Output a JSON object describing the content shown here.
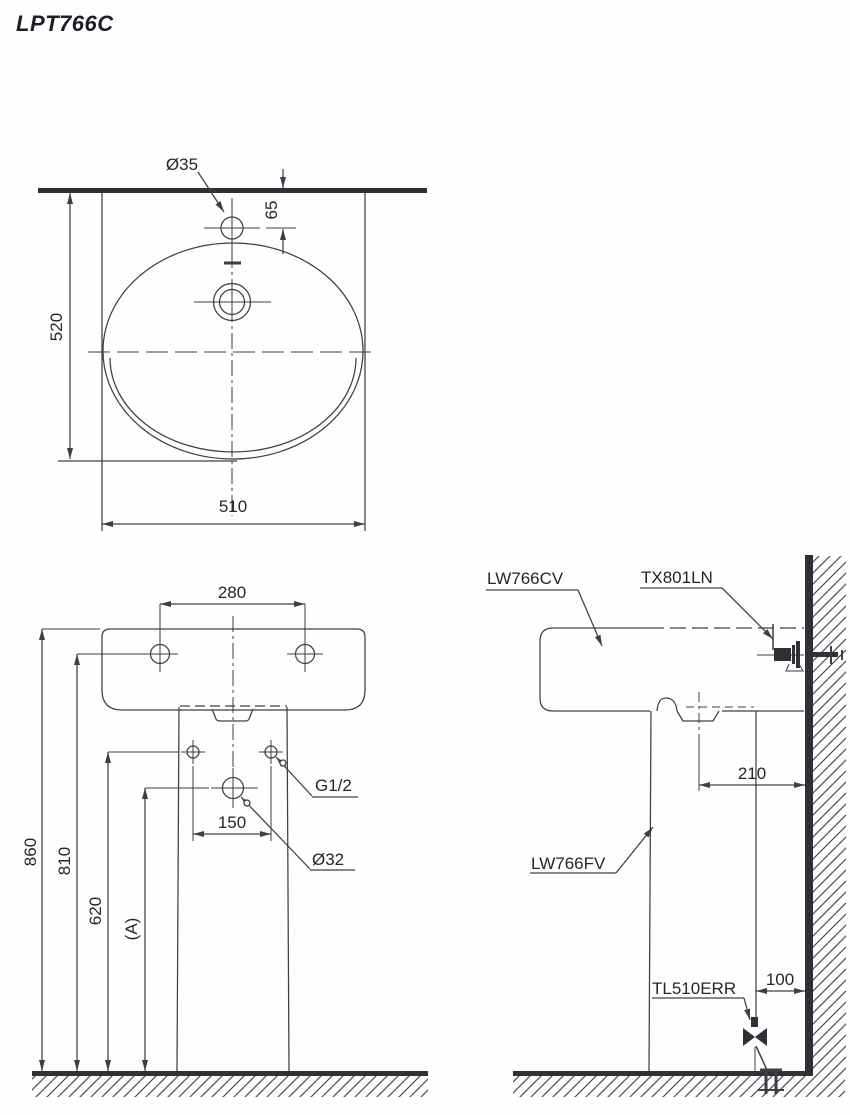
{
  "title": "LPT766C",
  "colors": {
    "line": "#3b4047",
    "text": "#22262d",
    "solid": "#2e3237"
  },
  "top_view": {
    "faucet_hole_dia": "Ø35",
    "faucet_offset": "65",
    "depth": "520",
    "width": "510"
  },
  "front_view": {
    "hole_spacing": "280",
    "total_height": "860",
    "mount_height": "810",
    "supply_height": "620",
    "drain_height": "(A)",
    "supply_spacing": "150",
    "supply_thread": "G1/2",
    "drain_dia": "Ø32"
  },
  "side_view": {
    "basin_model": "LW766CV",
    "faucet_model": "TX801LN",
    "pedestal_model": "LW766FV",
    "drain_valve_model": "TL510ERR",
    "drain_to_wall": "210",
    "valve_to_wall": "100"
  }
}
